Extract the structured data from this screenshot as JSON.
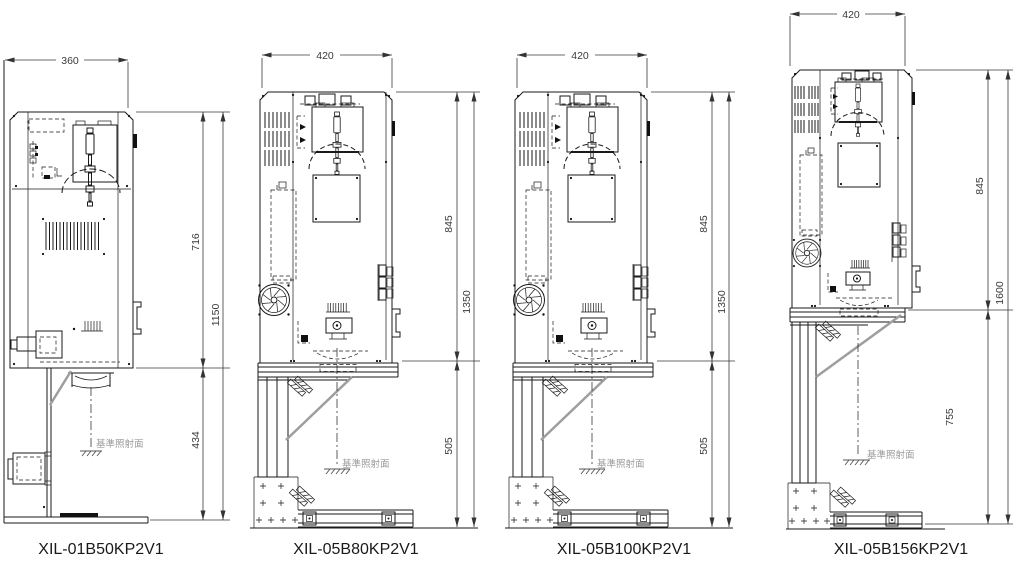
{
  "drawing": {
    "type": "engineering-dimension-drawing",
    "background": "#ffffff",
    "line_color": "#1a1a1a",
    "dimension_text_color": "#3a3a3a",
    "reference_text_color": "#9a9a9a"
  },
  "units": [
    {
      "model": "XIL-01B50KP2V1",
      "dim_width": "360",
      "dim_upper": "716",
      "dim_total": "1150",
      "dim_lower": "434",
      "reference_plane_label": "基準照射面"
    },
    {
      "model": "XIL-05B80KP2V1",
      "dim_width": "420",
      "dim_upper": "845",
      "dim_total": "1350",
      "dim_lower": "505",
      "reference_plane_label": "基準照射面"
    },
    {
      "model": "XIL-05B100KP2V1",
      "dim_width": "420",
      "dim_upper": "845",
      "dim_total": "1350",
      "dim_lower": "505",
      "reference_plane_label": "基準照射面"
    },
    {
      "model": "XIL-05B156KP2V1",
      "dim_width": "420",
      "dim_upper": "845",
      "dim_total": "1600",
      "dim_lower": "755",
      "reference_plane_label": "基準照射面"
    }
  ]
}
